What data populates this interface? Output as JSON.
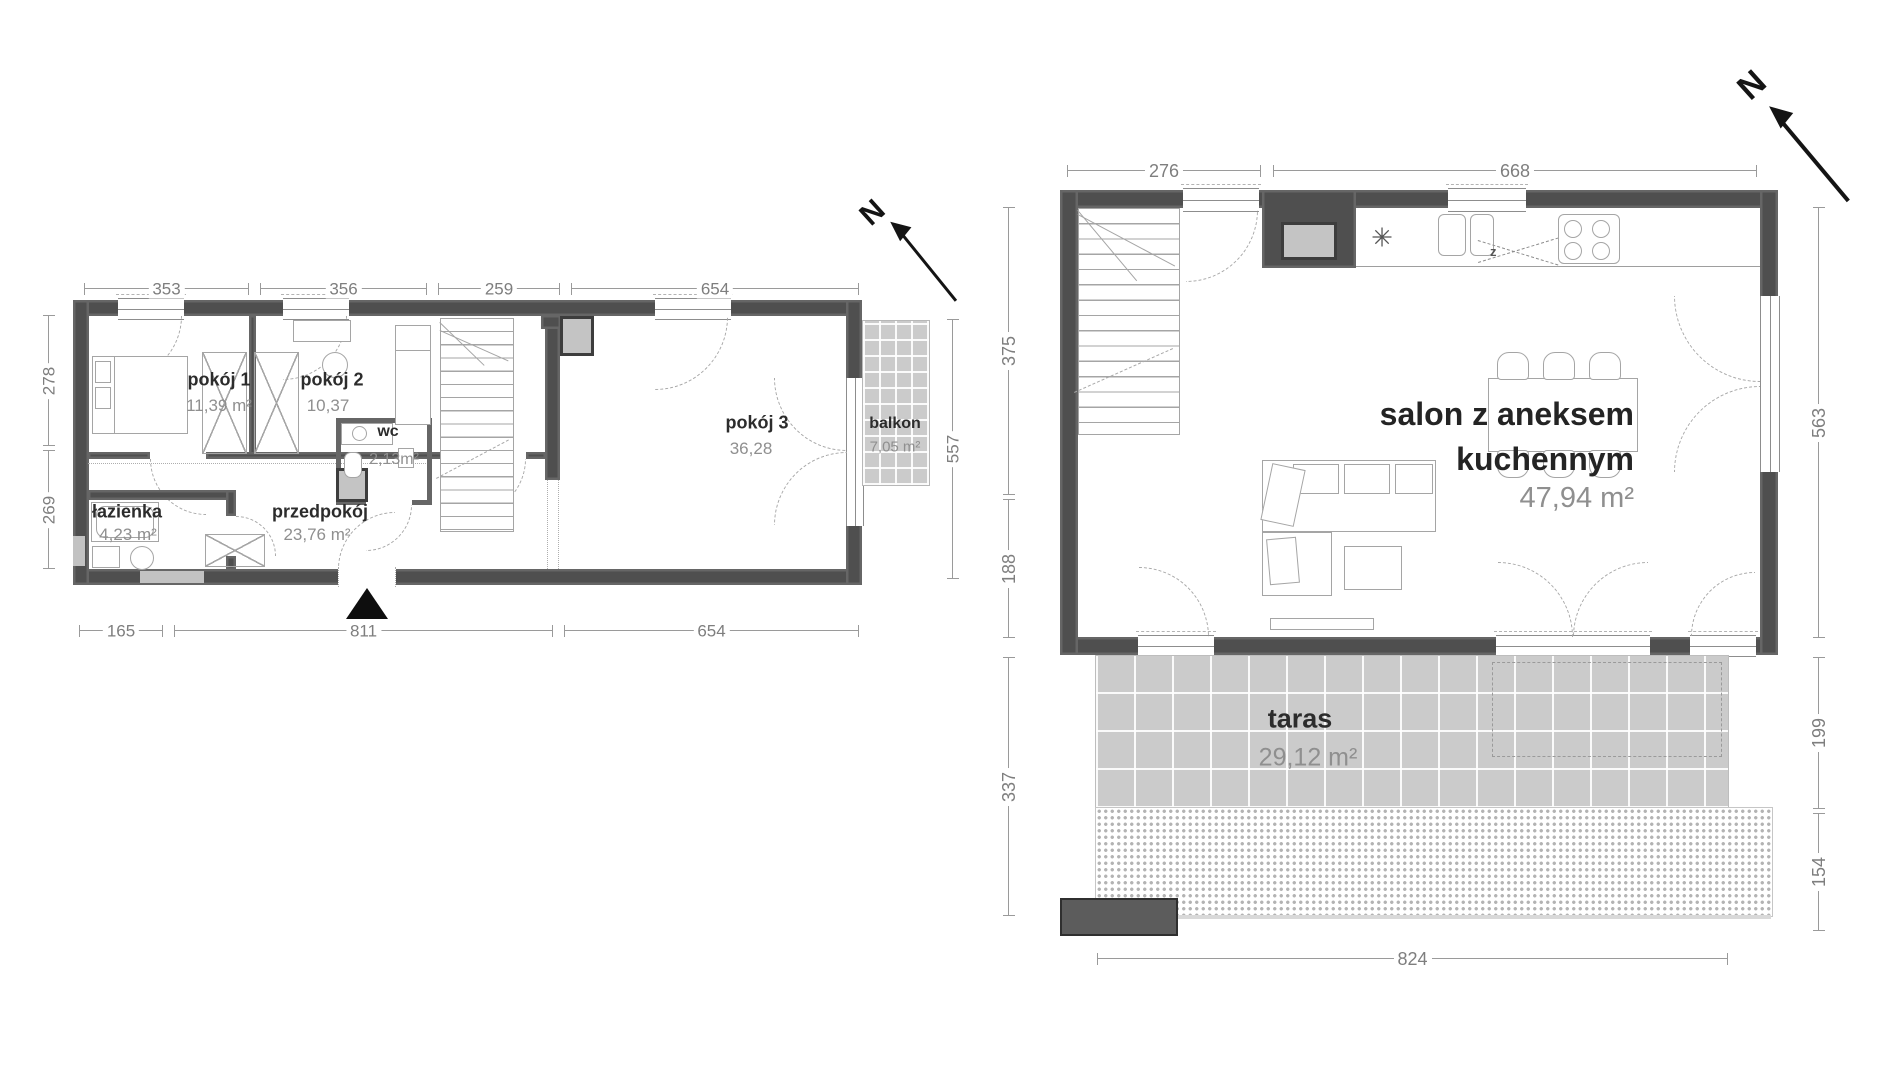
{
  "colors": {
    "wall": "#4f4f4f",
    "tile": "#cbcbcb",
    "accent": "#111111",
    "dim_text": "#7e7e7e",
    "area_text": "#8f8f8f",
    "room_text": "#2c2c2c"
  },
  "north": {
    "label": "N"
  },
  "floor1": {
    "rooms": {
      "pokoj1": {
        "name": "pokój 1",
        "area": "11,39 m²"
      },
      "pokoj2": {
        "name": "pokój 2",
        "area": "10,37"
      },
      "wc": {
        "name": "wc",
        "area": "2,13m²"
      },
      "pokoj3": {
        "name": "pokój 3",
        "area": "36,28"
      },
      "balkon": {
        "name": "balkon",
        "area": "7,05 m²"
      },
      "lazienka": {
        "name": "łazienka",
        "area": "4,23 m²"
      },
      "przedpokoj": {
        "name": "przedpokój",
        "area": "23,76 m²"
      }
    },
    "dims": {
      "top": [
        "353",
        "356",
        "259",
        "654"
      ],
      "bottom": [
        "165",
        "811",
        "654"
      ],
      "left": [
        "278",
        "269"
      ],
      "right": [
        "557"
      ]
    }
  },
  "floor2": {
    "rooms": {
      "salon": {
        "name_line1": "salon z aneksem",
        "name_line2": "kuchennym",
        "area": "47,94 m²"
      },
      "taras": {
        "name": "taras",
        "area": "29,12 m²"
      }
    },
    "kitchen": {
      "sink_label": "z",
      "heater_symbol": "✳"
    },
    "dims": {
      "top": [
        "276",
        "668"
      ],
      "left": [
        "375",
        "188",
        "337"
      ],
      "right": [
        "563",
        "199",
        "154"
      ],
      "bottom": [
        "824"
      ]
    }
  }
}
